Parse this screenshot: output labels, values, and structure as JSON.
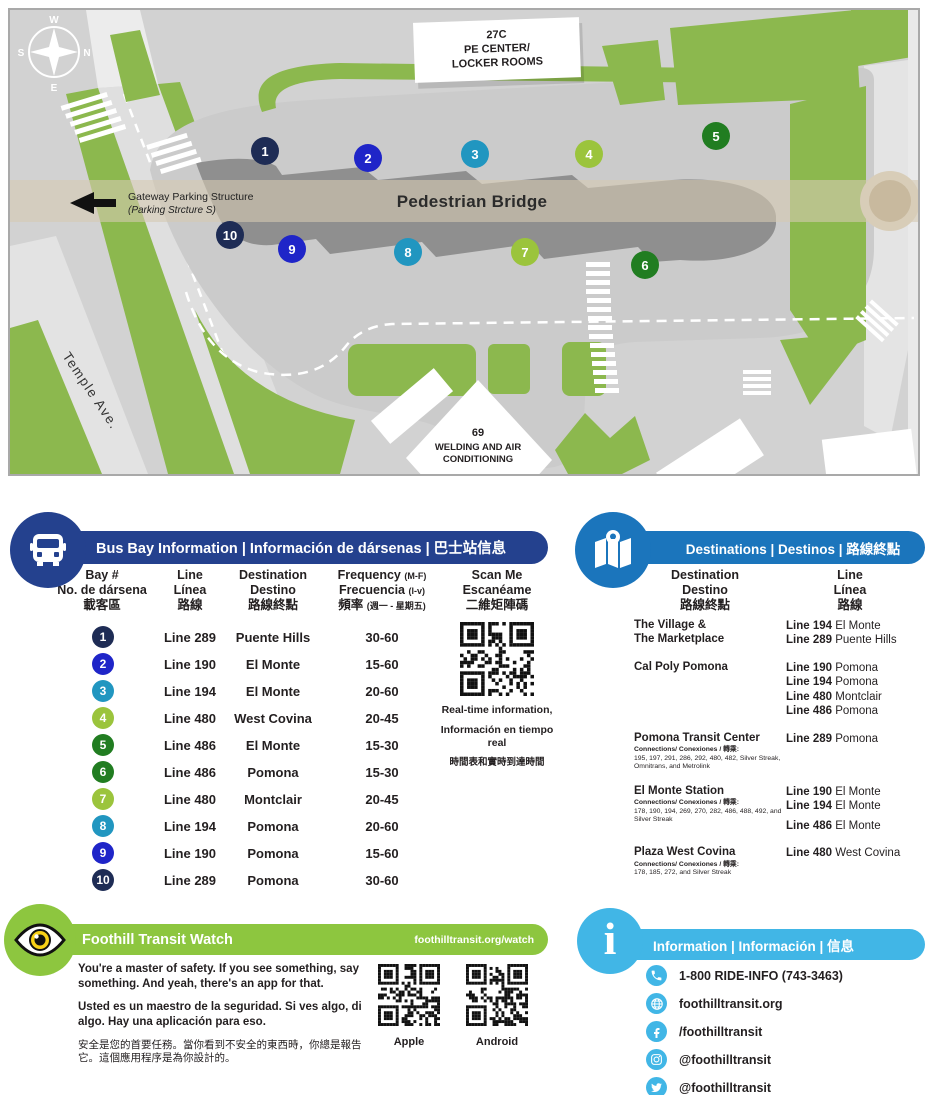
{
  "map": {
    "compass": {
      "w": "W",
      "n": "N",
      "s": "S",
      "e": "E"
    },
    "pe_center": [
      "27C",
      "PE CENTER/",
      "LOCKER ROOMS"
    ],
    "welding": [
      "69",
      "WELDING AND AIR",
      "CONDITIONING"
    ],
    "bridge_label": "Pedestrian Bridge",
    "gateway_line1": "Gateway Parking Structure",
    "gateway_line2": "(Parking Strcture S)",
    "street": "Temple Ave.",
    "bays": [
      {
        "num": "1",
        "color": "#1e2c55"
      },
      {
        "num": "2",
        "color": "#1f25c8"
      },
      {
        "num": "3",
        "color": "#2196c0"
      },
      {
        "num": "4",
        "color": "#9bc43c"
      },
      {
        "num": "5",
        "color": "#217d21"
      },
      {
        "num": "6",
        "color": "#217d21"
      },
      {
        "num": "7",
        "color": "#9bc43c"
      },
      {
        "num": "8",
        "color": "#2196c0"
      },
      {
        "num": "9",
        "color": "#1f25c8"
      },
      {
        "num": "10",
        "color": "#1e2c55"
      }
    ]
  },
  "bus_bay_panel": {
    "title": "Bus Bay Information | Información de dársenas | 巴士站信息",
    "headers": {
      "bay": [
        "Bay #",
        "No. de dársena",
        "載客區"
      ],
      "line": [
        "Line",
        "Línea",
        "路線"
      ],
      "dest": [
        "Destination",
        "Destino",
        "路線終點"
      ],
      "freq": [
        "Frequency",
        "Frecuencia",
        "頻率"
      ],
      "freq_notes": [
        "(M-F)",
        "(l-v)",
        "(週一 - 星期五)"
      ],
      "scan": [
        "Scan Me",
        "Escanéame",
        "二維矩陣碼"
      ]
    },
    "rows": [
      {
        "bay": "1",
        "color": "#1e2c55",
        "line": "Line 289",
        "dest": "Puente Hills",
        "freq": "30-60"
      },
      {
        "bay": "2",
        "color": "#1f25c8",
        "line": "Line 190",
        "dest": "El Monte",
        "freq": "15-60"
      },
      {
        "bay": "3",
        "color": "#2196c0",
        "line": "Line 194",
        "dest": "El Monte",
        "freq": "20-60"
      },
      {
        "bay": "4",
        "color": "#9bc43c",
        "line": "Line 480",
        "dest": "West Covina",
        "freq": "20-45"
      },
      {
        "bay": "5",
        "color": "#217d21",
        "line": "Line 486",
        "dest": "El Monte",
        "freq": "15-30"
      },
      {
        "bay": "6",
        "color": "#217d21",
        "line": "Line 486",
        "dest": "Pomona",
        "freq": "15-30"
      },
      {
        "bay": "7",
        "color": "#9bc43c",
        "line": "Line 480",
        "dest": "Montclair",
        "freq": "20-45"
      },
      {
        "bay": "8",
        "color": "#2196c0",
        "line": "Line 194",
        "dest": "Pomona",
        "freq": "20-60"
      },
      {
        "bay": "9",
        "color": "#1f25c8",
        "line": "Line 190",
        "dest": "Pomona",
        "freq": "15-60"
      },
      {
        "bay": "10",
        "color": "#1e2c55",
        "line": "Line 289",
        "dest": "Pomona",
        "freq": "30-60"
      }
    ],
    "qr_caption": [
      "Real-time information,",
      "Información en tiempo real",
      "時間表和實時到達時間"
    ]
  },
  "destinations_panel": {
    "title": "Destinations | Destinos | 路線終點",
    "headers": {
      "dest": [
        "Destination",
        "Destino",
        "路線終點"
      ],
      "line": [
        "Line",
        "Línea",
        "路線"
      ]
    },
    "entries": [
      {
        "name1": "The Village &",
        "name2": "The Marketplace",
        "conn_label": "",
        "conn_text": "",
        "lines": [
          {
            "line": "Line 194",
            "dest": "El Monte"
          },
          {
            "line": "Line 289",
            "dest": "Puente Hills"
          }
        ]
      },
      {
        "name1": "Cal Poly Pomona",
        "name2": "",
        "conn_label": "",
        "conn_text": "",
        "lines": [
          {
            "line": "Line 190",
            "dest": "Pomona"
          },
          {
            "line": "Line 194",
            "dest": "Pomona"
          },
          {
            "line": "Line 480",
            "dest": "Montclair"
          },
          {
            "line": "Line 486",
            "dest": "Pomona"
          }
        ]
      },
      {
        "name1": "Pomona Transit Center",
        "name2": "",
        "conn_label": "Connections/ Conexiones / 轉乘:",
        "conn_text": "195, 197, 291, 286, 292, 480, 482, Silver Streak, Omnitrans, and Metrolink",
        "lines": [
          {
            "line": "Line 289",
            "dest": "Pomona"
          }
        ]
      },
      {
        "name1": "El Monte Station",
        "name2": "",
        "conn_label": "Connections/ Conexiones / 轉乘:",
        "conn_text": "178, 190, 194, 269, 270, 282, 486, 488, 492, and Silver Streak",
        "lines": [
          {
            "line": "Line 190",
            "dest": "El Monte"
          },
          {
            "line": "Line 194",
            "dest": "El Monte"
          },
          {
            "line": "Line 486",
            "dest": "El Monte"
          }
        ]
      },
      {
        "name1": "Plaza West Covina",
        "name2": "",
        "conn_label": "Connections/ Conexiones / 轉乘:",
        "conn_text": "178, 185, 272, and Silver Streak",
        "lines": [
          {
            "line": "Line 480",
            "dest": "West Covina"
          }
        ]
      }
    ]
  },
  "watch_panel": {
    "title": "Foothill Transit Watch",
    "url": "foothilltransit.org/watch",
    "p_en": "You're a master of safety. If you see something, say something. And yeah, there's an app for that.",
    "p_es": "Usted es un maestro de la seguridad. Si ves algo, di algo. Hay una  aplicación para eso.",
    "p_zh": "安全是您的首要任務。當你看到不安全的東西時，你總是報告它。這個應用程序是為你設計的。",
    "qr_apple_label": "Apple",
    "qr_android_label": "Android"
  },
  "info_panel": {
    "title": "Information | Información | 信息",
    "items": [
      {
        "icon": "phone-icon",
        "label": "1-800 RIDE-INFO (743-3463)"
      },
      {
        "icon": "globe-icon",
        "label": "foothilltransit.org"
      },
      {
        "icon": "facebook-icon",
        "label": "/foothilltransit"
      },
      {
        "icon": "instagram-icon",
        "label": "@foothilltransit"
      },
      {
        "icon": "twitter-icon",
        "label": "@foothilltransit"
      }
    ]
  },
  "colors": {
    "banner_navy": "#24418e",
    "banner_blue": "#1b75bc",
    "banner_green": "#8dc63f",
    "banner_sky": "#41b6e6",
    "map_green": "#8cb84e",
    "platform_gray": "#8f8f8f",
    "bridge_tan": "#ddd3c2"
  }
}
